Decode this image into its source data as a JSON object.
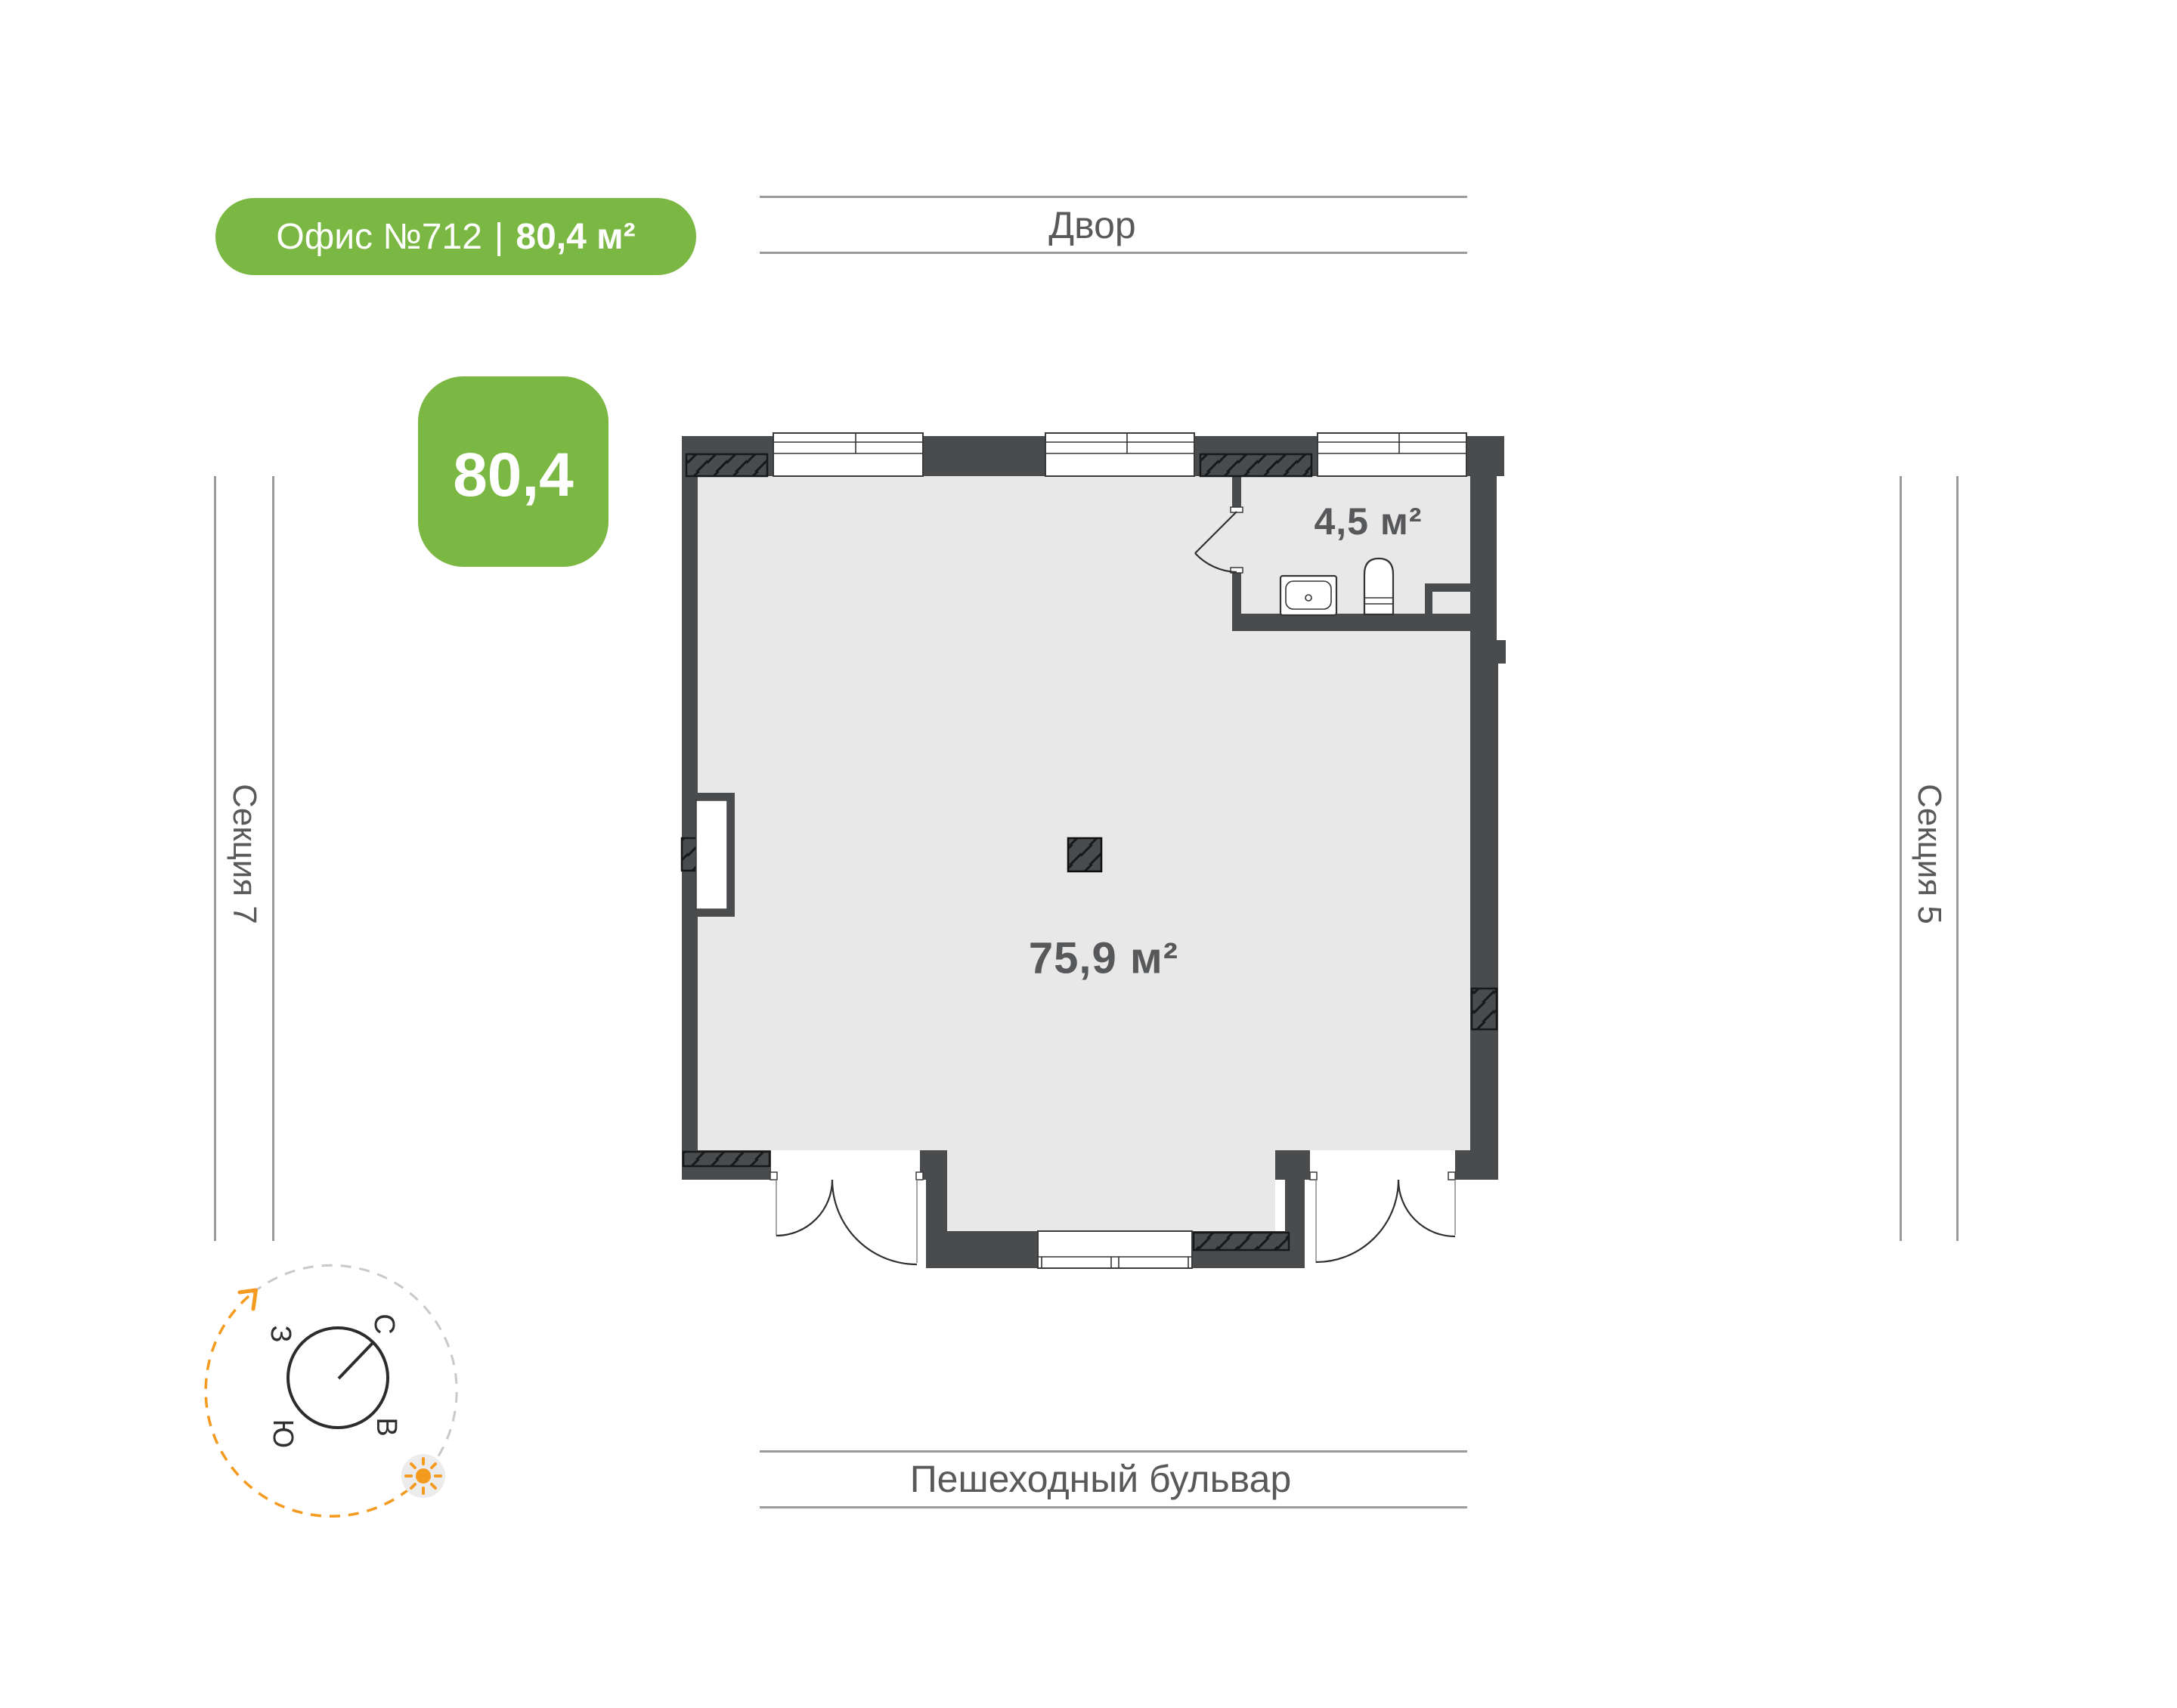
{
  "badge": {
    "office": "Офис №712",
    "divider": "|",
    "area": "80,4 м²"
  },
  "area_tile": {
    "value": "80,4"
  },
  "plan": {
    "main_room_area": "75,9 м²",
    "bathroom_area": "4,5 м²"
  },
  "surroundings": {
    "top": "Двор",
    "bottom": "Пешеходный бульвар",
    "left": "Секция 7",
    "right": "Секция 5"
  },
  "compass": {
    "north": "С",
    "south": "Ю",
    "west": "З",
    "east": "В"
  },
  "colors": {
    "green": "#7bb843",
    "wall": "#4a4b4d",
    "floor": "#e8e8e9",
    "text": "#58595b",
    "line": "#9b9b9b",
    "orange": "#f49a1f"
  }
}
